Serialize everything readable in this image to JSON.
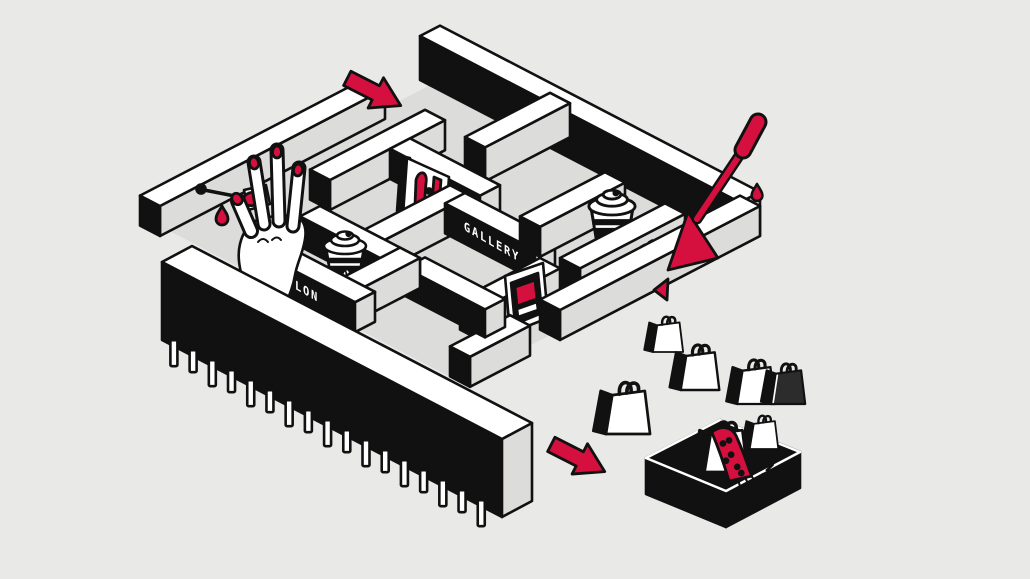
{
  "illustration": {
    "palette": {
      "background": "#e9e9e8",
      "ink": "#111111",
      "paper": "#ffffff",
      "shade": "#dcdcdb",
      "accent": "#d5103e"
    },
    "labels": {
      "salon": "SALON",
      "gallery": "GALLERY",
      "coffee": "COFFEE",
      "prize": "PRIZE"
    }
  }
}
